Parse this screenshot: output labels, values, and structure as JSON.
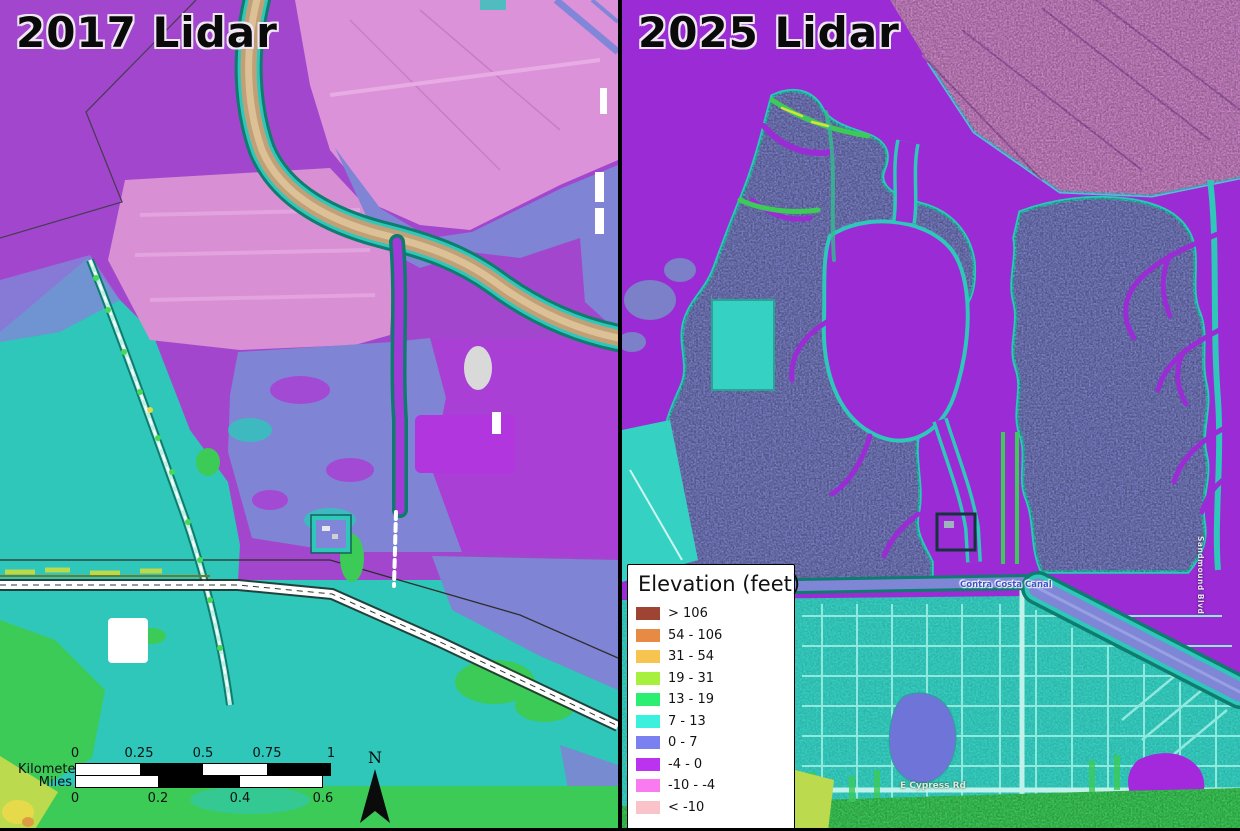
{
  "panels": [
    {
      "title": "2017 Lidar"
    },
    {
      "title": "2025 Lidar"
    }
  ],
  "legend": {
    "title": "Elevation (feet)",
    "items": [
      {
        "label": "> 106",
        "color": "#9f4433"
      },
      {
        "label": "54 - 106",
        "color": "#e78a44"
      },
      {
        "label": "31 - 54",
        "color": "#f6c44f"
      },
      {
        "label": "19 - 31",
        "color": "#a8f03e"
      },
      {
        "label": "13 - 19",
        "color": "#2bef70"
      },
      {
        "label": "7 - 13",
        "color": "#3bf0dc"
      },
      {
        "label": "0 - 7",
        "color": "#7a80ef"
      },
      {
        "label": "-4 - 0",
        "color": "#bb33ee"
      },
      {
        "label": "-10 - -4",
        "color": "#fa7af0"
      },
      {
        "label": "< -10",
        "color": "#f9c3c9"
      }
    ]
  },
  "scale_bar": {
    "kilometers_label": "Kilometers",
    "miles_label": "Miles",
    "km_ticks": [
      "0",
      "0.25",
      "0.5",
      "0.75",
      "1"
    ],
    "mile_ticks": [
      "0",
      "0.2",
      "0.4",
      "0.6"
    ]
  },
  "north_arrow": {
    "label": "N"
  },
  "map_labels": {
    "canal": "Contra Costa Canal",
    "road_south": "E Cypress Rd",
    "road_east": "Sandmound Blvd"
  },
  "colors": {
    "divider": "#000000",
    "purple_2017": "#a247cd",
    "purple_2025": "#9b2bd4",
    "teal": "#2ec7b9",
    "marsh_blue": "#7b80c9",
    "lavender": "#7f84d4",
    "pink_fields": "#d88fd4",
    "tan_channel": "#c2a077",
    "green": "#3ccb57",
    "yellow_green": "#bcda4d",
    "white_road": "#ffffff"
  }
}
